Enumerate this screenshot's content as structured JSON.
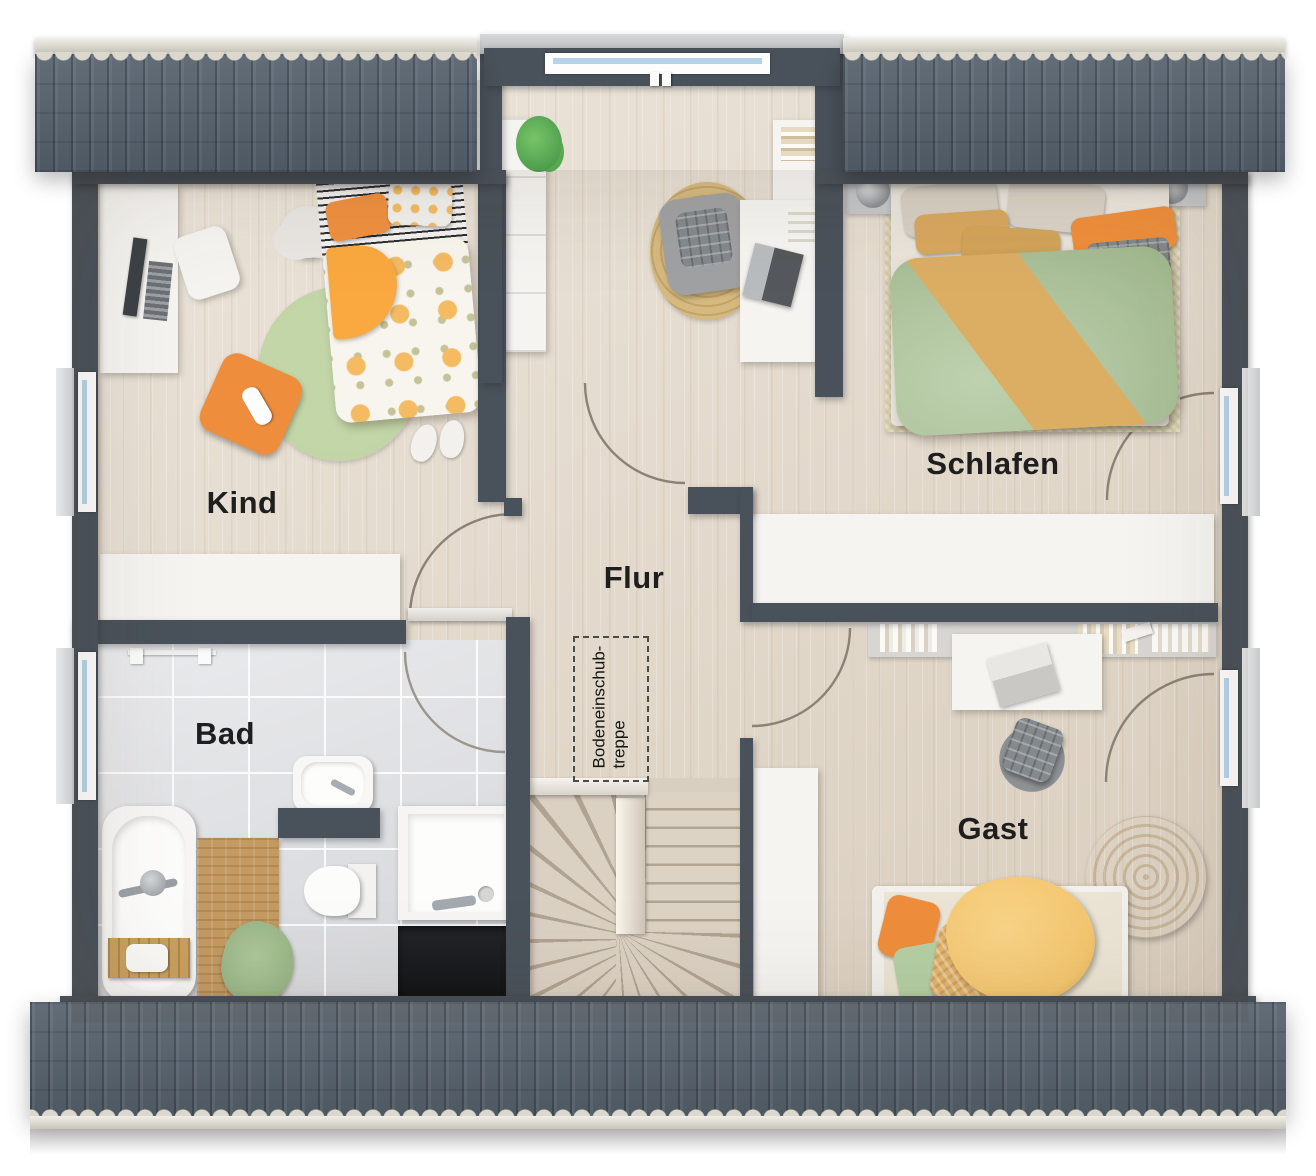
{
  "floorplan": {
    "type": "residential-upper-floor-plan",
    "rooms": [
      {
        "id": "kind",
        "label": "Kind"
      },
      {
        "id": "schlafen",
        "label": "Schlafen"
      },
      {
        "id": "flur",
        "label": "Flur"
      },
      {
        "id": "bad",
        "label": "Bad"
      },
      {
        "id": "gast",
        "label": "Gast"
      }
    ],
    "annotation": {
      "id": "bodeneinschubtreppe",
      "label": "Bodeneinschub-\ntreppe"
    }
  },
  "colors": {
    "wall": "#49515a",
    "roof": "#57626e",
    "roof_ridge": "#dcd8cd",
    "floor_wood": "#e4dacb",
    "floor_tile": "#dfe0e3",
    "window_glass": "#b5d3e8",
    "door_arc": "#8b8175",
    "label_text": "#1e1e1e",
    "accent_orange": "#ee8e3c",
    "accent_yellow": "#f3c66f",
    "accent_green_duvet": "#a9c295",
    "accent_tan": "#dcae64",
    "rug_green": "#bed2a4",
    "rug_jute": "#d6b97f",
    "furniture_white": "#f5f4f1"
  }
}
